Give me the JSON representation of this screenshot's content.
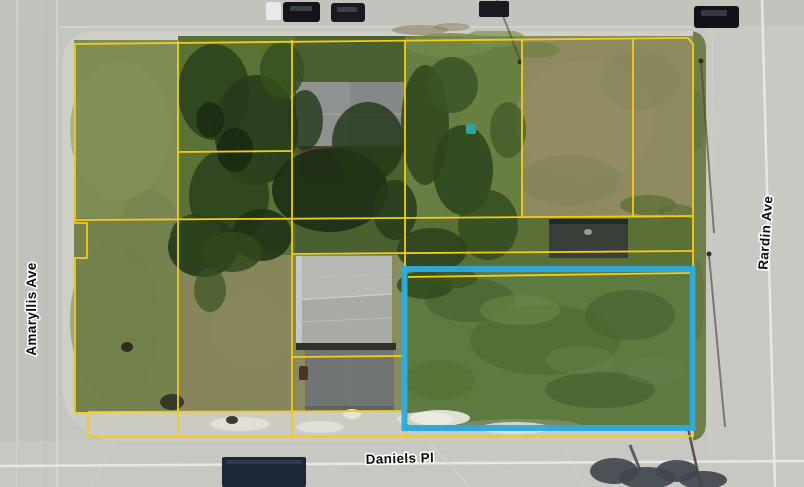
{
  "map": {
    "type": "aerial-parcel-map",
    "streets": {
      "left": "Amaryllis Ave",
      "right": "Rardin Ave",
      "bottom": "Daniels Pl"
    },
    "overlay": {
      "parcel_line_color": "#F2CC1A",
      "highlight_color": "#29ABE2",
      "label_color": "#0A0A0A",
      "label_halo_color": "#FFFFFF"
    }
  }
}
